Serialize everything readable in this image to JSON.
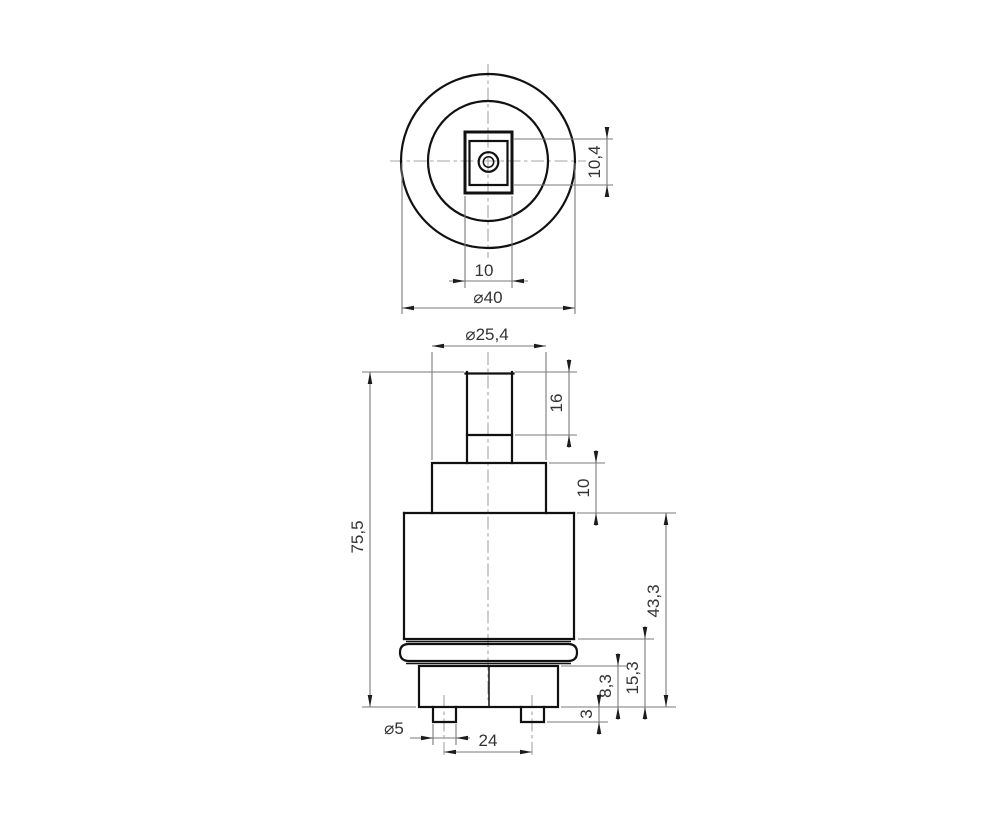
{
  "drawing": {
    "type": "technical-orthographic-drawing",
    "colors": {
      "background": "#ffffff",
      "ink": "#111111",
      "dimension_lines": "#7a7a7a",
      "centerlines": "#a6a6a6"
    }
  },
  "dimensions": {
    "top": {
      "square_height": "10,4",
      "square_width": "10",
      "outer_diameter": "⌀40"
    },
    "front": {
      "collar_diameter": "⌀25,4",
      "stem_height": "16",
      "neck_height": "10",
      "overall_height": "75,5",
      "body_height": "43,3",
      "lower_height": "15,3",
      "base_height": "8,3",
      "pin_length": "3",
      "pin_diameter": "⌀5",
      "pin_spacing": "24"
    }
  }
}
